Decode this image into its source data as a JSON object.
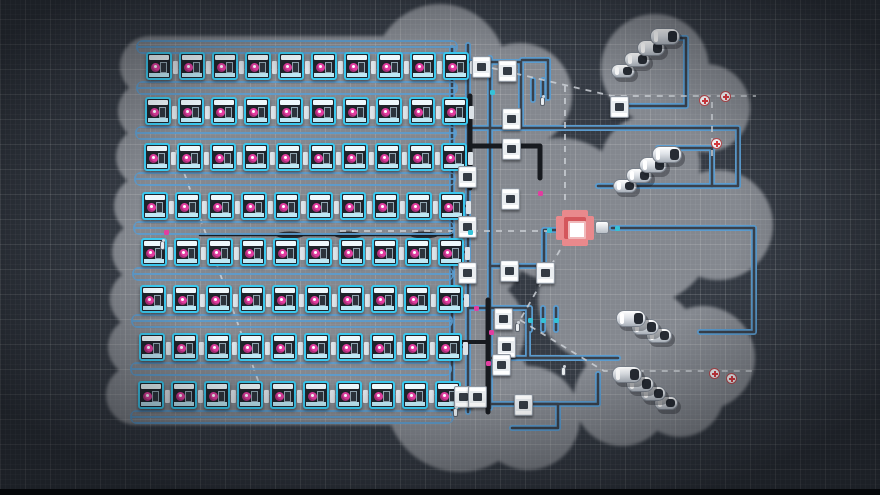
{
  "scene": {
    "canvas": {
      "width": 880,
      "height": 495
    },
    "colors": {
      "bg": "#353b44",
      "blob": "#84888f",
      "cyan": "#3bc8ee",
      "cyan_dark": "#1f242b",
      "magenta": "#e23da0",
      "belt_blue": "#5b9ccf",
      "belt_core": "#3a414b",
      "dark_belt": "#171a1f",
      "white_machine": "#e9edf0",
      "red_frame": "#e9898c",
      "red_core": "#d4575c",
      "dashed": "#ccd1d7",
      "medkit_red": "#d8393f",
      "engine_dark": "#262b33"
    },
    "blob_capsules": [
      {
        "x": 120,
        "y": 36,
        "w": 360,
        "h": 60
      },
      {
        "x": 118,
        "y": 81,
        "w": 360,
        "h": 60
      },
      {
        "x": 116,
        "y": 127,
        "w": 360,
        "h": 60
      },
      {
        "x": 114,
        "y": 176,
        "w": 360,
        "h": 60
      },
      {
        "x": 112,
        "y": 222,
        "w": 360,
        "h": 60
      },
      {
        "x": 110,
        "y": 269,
        "w": 360,
        "h": 60
      },
      {
        "x": 108,
        "y": 317,
        "w": 360,
        "h": 60
      },
      {
        "x": 106,
        "y": 365,
        "w": 362,
        "h": 60
      }
    ],
    "blob_circles": [
      {
        "cx": 440,
        "cy": 70,
        "r": 66
      },
      {
        "cx": 520,
        "cy": 95,
        "r": 52
      },
      {
        "cx": 476,
        "cy": 160,
        "r": 58
      },
      {
        "cx": 470,
        "cy": 250,
        "r": 55
      },
      {
        "cx": 470,
        "cy": 330,
        "r": 55
      },
      {
        "cx": 560,
        "cy": 210,
        "r": 72
      },
      {
        "cx": 640,
        "cy": 230,
        "r": 75
      },
      {
        "cx": 718,
        "cy": 225,
        "r": 55
      },
      {
        "cx": 600,
        "cy": 300,
        "r": 62
      },
      {
        "cx": 655,
        "cy": 68,
        "r": 54
      },
      {
        "cx": 706,
        "cy": 108,
        "r": 44
      },
      {
        "cx": 650,
        "cy": 165,
        "r": 50
      },
      {
        "cx": 640,
        "cy": 345,
        "r": 58
      },
      {
        "cx": 703,
        "cy": 358,
        "r": 52
      },
      {
        "cx": 622,
        "cy": 398,
        "r": 48
      },
      {
        "cx": 680,
        "cy": 393,
        "r": 44
      },
      {
        "cx": 460,
        "cy": 398,
        "r": 74
      },
      {
        "cx": 528,
        "cy": 418,
        "r": 52
      }
    ],
    "machine_rows": [
      {
        "x": 146,
        "y": 52,
        "count": 10,
        "spacing": 33
      },
      {
        "x": 145,
        "y": 97,
        "count": 10,
        "spacing": 33
      },
      {
        "x": 144,
        "y": 143,
        "count": 10,
        "spacing": 33
      },
      {
        "x": 142,
        "y": 192,
        "count": 10,
        "spacing": 33
      },
      {
        "x": 141,
        "y": 238,
        "count": 10,
        "spacing": 33
      },
      {
        "x": 140,
        "y": 285,
        "count": 10,
        "spacing": 33
      },
      {
        "x": 139,
        "y": 333,
        "count": 10,
        "spacing": 33
      },
      {
        "x": 138,
        "y": 381,
        "count": 10,
        "spacing": 33
      }
    ],
    "belt_bundles": [
      {
        "x": 136,
        "y": 40,
        "w": 322
      },
      {
        "x": 136,
        "y": 81,
        "w": 322
      },
      {
        "x": 135,
        "y": 126,
        "w": 322
      },
      {
        "x": 134,
        "y": 172,
        "w": 322
      },
      {
        "x": 133,
        "y": 221,
        "w": 322
      },
      {
        "x": 132,
        "y": 267,
        "w": 322
      },
      {
        "x": 131,
        "y": 314,
        "w": 322
      },
      {
        "x": 130,
        "y": 362,
        "w": 322
      },
      {
        "x": 130,
        "y": 410,
        "w": 324
      }
    ],
    "conveyors": [
      "M468,45 V412",
      "M452,48 V410",
      "M490,58 V408",
      "M468,62 H521 V128",
      "M468,128 H738 V186 H712",
      "M598,186 H712 V148 H658",
      "M612,228 H754 V332 H700",
      "M490,266 H544 V230 H556",
      "M468,308 H528 V358 H618",
      "M490,358 H560",
      "M468,404 H558 V428 H512",
      "M520,404 H598 V374",
      "M522,60 H548 V98",
      "M618,106 H686 V38 H654",
      "M530,308 V330",
      "M543,308 V330",
      "M556,308 V330",
      "M533,80 V100",
      "M543,80 V100",
      "M450,66 H468",
      "M450,112 H468",
      "M450,158 H468",
      "M450,206 H468",
      "M450,252 H468",
      "M450,299 H468",
      "M450,347 H468",
      "M450,396 H468"
    ],
    "dark_belts": [
      {
        "d": "M470,96 V188",
        "w": 5
      },
      {
        "d": "M470,146 H540 V178",
        "w": 5
      },
      {
        "d": "M488,300 V412",
        "w": 5
      },
      {
        "d": "M442,342 H488",
        "w": 4
      },
      {
        "d": "M200,235 H452",
        "w": 2.5
      }
    ],
    "belt_lenses": [
      {
        "cx": 290,
        "cy": 235
      },
      {
        "cx": 348,
        "cy": 235
      },
      {
        "cx": 424,
        "cy": 235
      }
    ],
    "dashed_routes": [
      "M492,68 L612,96 H756",
      "M565,86 V206",
      "M340,231 H554",
      "M176,150 L260,386",
      "M560,250 L520,320",
      "M520,320 L604,371 H754",
      "M712,102 V158"
    ],
    "white_machines": [
      {
        "x": 472,
        "y": 56
      },
      {
        "x": 498,
        "y": 60
      },
      {
        "x": 502,
        "y": 108
      },
      {
        "x": 502,
        "y": 138
      },
      {
        "x": 458,
        "y": 166
      },
      {
        "x": 501,
        "y": 188
      },
      {
        "x": 458,
        "y": 216
      },
      {
        "x": 458,
        "y": 262
      },
      {
        "x": 500,
        "y": 260
      },
      {
        "x": 494,
        "y": 308
      },
      {
        "x": 497,
        "y": 336
      },
      {
        "x": 492,
        "y": 354
      },
      {
        "x": 514,
        "y": 394
      },
      {
        "x": 454,
        "y": 386
      },
      {
        "x": 468,
        "y": 386
      },
      {
        "x": 610,
        "y": 96
      },
      {
        "x": 536,
        "y": 262
      }
    ],
    "engine_clusters": [
      {
        "x": 650,
        "y": 28,
        "count": 4,
        "dx": -13,
        "dy": 12
      },
      {
        "x": 652,
        "y": 146,
        "count": 4,
        "dx": -13,
        "dy": 11
      },
      {
        "x": 616,
        "y": 310,
        "count": 3,
        "dx": 15,
        "dy": 9
      },
      {
        "x": 612,
        "y": 366,
        "count": 4,
        "dx": 14,
        "dy": 10
      }
    ],
    "red_machine": {
      "x": 556,
      "y": 210
    },
    "medkits": [
      {
        "x": 699,
        "y": 95
      },
      {
        "x": 720,
        "y": 91
      },
      {
        "x": 711,
        "y": 138
      },
      {
        "x": 709,
        "y": 368
      },
      {
        "x": 726,
        "y": 373
      }
    ],
    "workers": [
      {
        "x": 160,
        "y": 241
      },
      {
        "x": 453,
        "y": 408
      },
      {
        "x": 515,
        "y": 323
      },
      {
        "x": 561,
        "y": 367
      },
      {
        "x": 540,
        "y": 97
      }
    ],
    "belt_items": [
      {
        "x": 489,
        "y": 330,
        "c": "#e23da0"
      },
      {
        "x": 486,
        "y": 361,
        "c": "#e23da0"
      },
      {
        "x": 474,
        "y": 306,
        "c": "#e23da0"
      },
      {
        "x": 538,
        "y": 191,
        "c": "#e23da0"
      },
      {
        "x": 164,
        "y": 230,
        "c": "#e23da0"
      },
      {
        "x": 528,
        "y": 318,
        "c": "#35c2d8"
      },
      {
        "x": 541,
        "y": 318,
        "c": "#35c2d8"
      },
      {
        "x": 554,
        "y": 318,
        "c": "#35c2d8"
      },
      {
        "x": 615,
        "y": 226,
        "c": "#35c2d8"
      },
      {
        "x": 547,
        "y": 228,
        "c": "#35c2d8"
      },
      {
        "x": 468,
        "y": 230,
        "c": "#35c2d8"
      },
      {
        "x": 490,
        "y": 90,
        "c": "#35c2d8"
      }
    ]
  }
}
